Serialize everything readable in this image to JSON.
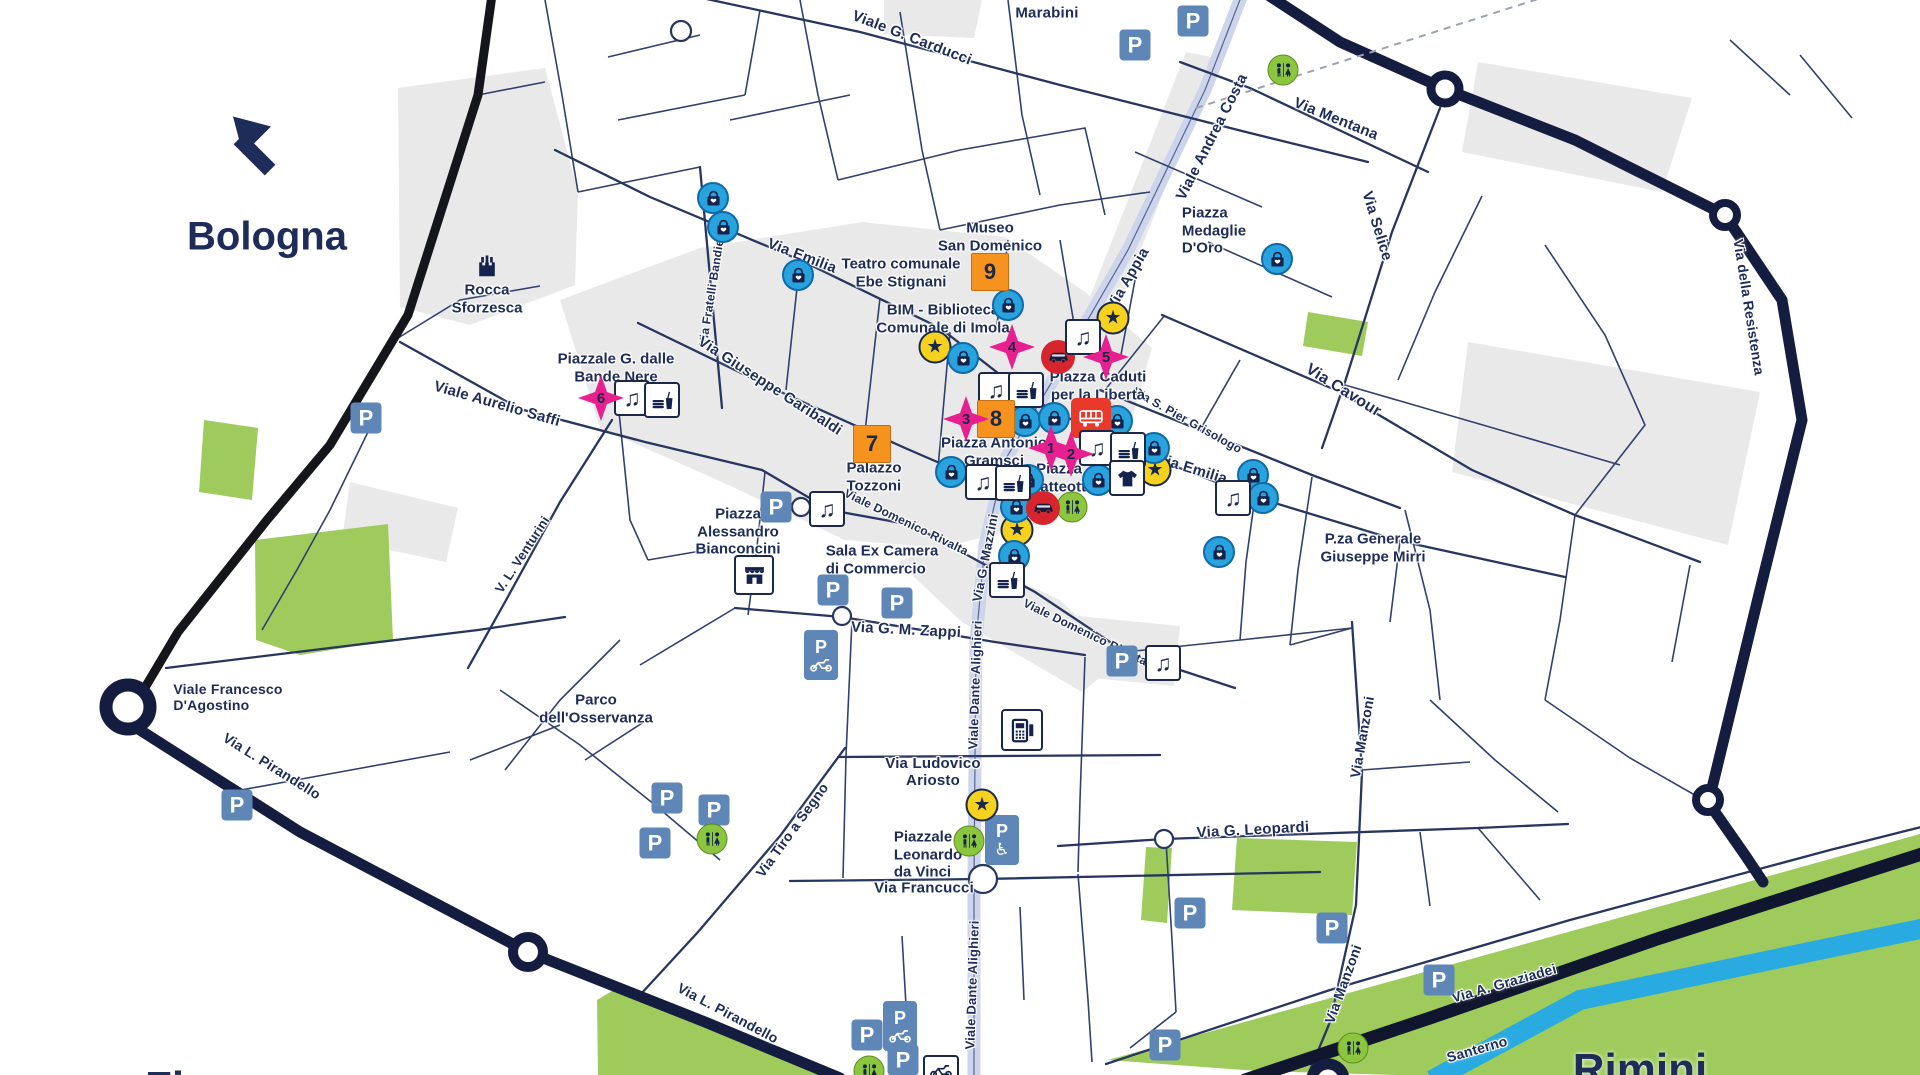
{
  "map": {
    "direction_labels": {
      "bologna": "Bologna",
      "rimini": "Rimini",
      "firenze": "Firenze"
    },
    "colors": {
      "navy_text": "#1d2c58",
      "thin_street": "#31406c",
      "ring_road": "#141d40",
      "boundary_black": "#15151c",
      "river_blue": "#29abe2",
      "main_axis_band": "#cdd5ec",
      "park_green": "#9ecb5c",
      "building_gray": "#e9e9ea",
      "parking_blue": "#5e86b7",
      "poi_yellow": "#f6d21f",
      "shopping_blue": "#29a3de",
      "restricted_red": "#d6252e",
      "bus_red": "#e8392b",
      "marker_orange": "#f6921e",
      "marker_pink": "#e81f8e",
      "wc_green": "#8cc63e"
    },
    "icon_glyphs": {
      "parking": "P",
      "music": "♫",
      "star": "★",
      "wheelchair": "♿"
    },
    "street_labels": [
      {
        "t": "Marabini",
        "x": 1047,
        "y": 13,
        "r": 0,
        "s": 15
      },
      {
        "t": "Viale G. Carducci",
        "x": 912,
        "y": 38,
        "r": 21,
        "s": 15
      },
      {
        "t": "Via Mentana",
        "x": 1336,
        "y": 119,
        "r": 22,
        "s": 15
      },
      {
        "t": "Via Selice",
        "x": 1377,
        "y": 226,
        "r": 73,
        "s": 15
      },
      {
        "t": "Viale Andrea Costa",
        "x": 1212,
        "y": 137,
        "r": -63,
        "s": 15
      },
      {
        "t": "Via Appia",
        "x": 1128,
        "y": 279,
        "r": -60,
        "s": 15
      },
      {
        "t": "Via Emilia",
        "x": 802,
        "y": 256,
        "r": 21,
        "s": 15
      },
      {
        "t": "Via Emilia",
        "x": 1192,
        "y": 469,
        "r": 17,
        "s": 15
      },
      {
        "t": "Via Fratelli Bandiera",
        "x": 713,
        "y": 287,
        "r": -81,
        "s": 12
      },
      {
        "t": "Via Giuseppe Garibaldi",
        "x": 770,
        "y": 386,
        "r": 33,
        "s": 15
      },
      {
        "t": "Viale Aurelio Saffi",
        "x": 497,
        "y": 404,
        "r": 16,
        "s": 15
      },
      {
        "t": "Via Cavour",
        "x": 1343,
        "y": 391,
        "r": 32,
        "s": 16
      },
      {
        "t": "Via della Resistenza",
        "x": 1749,
        "y": 307,
        "r": 81,
        "s": 14
      },
      {
        "t": "Via S. Pier Grisologo",
        "x": 1187,
        "y": 421,
        "r": 29,
        "s": 12
      },
      {
        "t": "Viale Domenico Rivalta",
        "x": 906,
        "y": 523,
        "r": 26,
        "s": 12
      },
      {
        "t": "Viale Domenico Rivalta",
        "x": 1085,
        "y": 633,
        "r": 26,
        "s": 12
      },
      {
        "t": "Via G. Mazzini",
        "x": 986,
        "y": 558,
        "r": -79,
        "s": 13
      },
      {
        "t": "Viale Dante Alighieri",
        "x": 976,
        "y": 685,
        "r": -88,
        "s": 13
      },
      {
        "t": "Viale Dante Alighieri",
        "x": 973,
        "y": 985,
        "r": -88,
        "s": 13
      },
      {
        "t": "Via G. M. Zappi",
        "x": 906,
        "y": 630,
        "r": 3,
        "s": 15
      },
      {
        "t": "Via Ludovico\nAriosto",
        "x": 933,
        "y": 772,
        "r": 0,
        "s": 15
      },
      {
        "t": "Via Francucci",
        "x": 924,
        "y": 888,
        "r": 0,
        "s": 15
      },
      {
        "t": "Via G. Leopardi",
        "x": 1253,
        "y": 830,
        "r": -3,
        "s": 15
      },
      {
        "t": "Via Manzoni",
        "x": 1362,
        "y": 737,
        "r": -80,
        "s": 14
      },
      {
        "t": "Via Manzoni",
        "x": 1343,
        "y": 984,
        "r": -70,
        "s": 14
      },
      {
        "t": "Via A. Graziadei",
        "x": 1504,
        "y": 983,
        "r": -16,
        "s": 14
      },
      {
        "t": "Santerno",
        "x": 1477,
        "y": 1049,
        "r": -16,
        "s": 14
      },
      {
        "t": "Via Tiro a Segno",
        "x": 792,
        "y": 830,
        "r": -54,
        "s": 14
      },
      {
        "t": "Via L. Pirandello",
        "x": 272,
        "y": 766,
        "r": 32,
        "s": 14
      },
      {
        "t": "Via L. Pirandello",
        "x": 728,
        "y": 1013,
        "r": 28,
        "s": 14
      },
      {
        "t": "V. L. Venturini",
        "x": 523,
        "y": 555,
        "r": -57,
        "s": 13
      },
      {
        "t": "Viale Francesco\nD'Agostino",
        "x": 228,
        "y": 697,
        "r": 0,
        "s": 14,
        "al": "l"
      }
    ],
    "poi_labels": [
      {
        "t": "Rocca\nSforzesca",
        "x": 487,
        "y": 299
      },
      {
        "t": "Museo\nSan Domenico",
        "x": 990,
        "y": 237
      },
      {
        "t": "Teatro comunale\nEbe Stignani",
        "x": 901,
        "y": 273
      },
      {
        "t": "BIM - Biblioteca\nComunale di Imola",
        "x": 943,
        "y": 319
      },
      {
        "t": "Piazza\nMedaglie\nD'Oro",
        "x": 1214,
        "y": 231,
        "al": "l"
      },
      {
        "t": "Piazza Caduti\nper la Libertà",
        "x": 1098,
        "y": 386
      },
      {
        "t": "Piazza Antonio\nGramsci",
        "x": 994,
        "y": 452
      },
      {
        "t": "Piazza\nMatteotti",
        "x": 1059,
        "y": 478
      },
      {
        "t": "Palazzo\nTozzoni",
        "x": 874,
        "y": 477,
        "al": "l"
      },
      {
        "t": "Piazzale G. dalle\nBande Nere",
        "x": 616,
        "y": 368
      },
      {
        "t": "Piazza\nAlessandro\nBianconcini",
        "x": 738,
        "y": 532
      },
      {
        "t": "Sala Ex Camera\ndi Commercio",
        "x": 882,
        "y": 560,
        "al": "l"
      },
      {
        "t": "Parco\ndell'Osservanza",
        "x": 596,
        "y": 709
      },
      {
        "t": "Piazzale\nLeonardo\nda Vinci",
        "x": 928,
        "y": 855,
        "al": "l"
      },
      {
        "t": "P.za Generale\nGiuseppe Mirri",
        "x": 1373,
        "y": 548
      }
    ],
    "numbered_markers": {
      "orange": [
        {
          "n": "9",
          "x": 990,
          "y": 272
        },
        {
          "n": "8",
          "x": 996,
          "y": 419
        },
        {
          "n": "7",
          "x": 872,
          "y": 444
        }
      ],
      "pink": [
        {
          "n": "6",
          "x": 601,
          "y": 398
        },
        {
          "n": "4",
          "x": 1012,
          "y": 347
        },
        {
          "n": "5",
          "x": 1106,
          "y": 357
        },
        {
          "n": "3",
          "x": 966,
          "y": 419
        },
        {
          "n": "1",
          "x": 1051,
          "y": 448
        },
        {
          "n": "2",
          "x": 1071,
          "y": 454
        }
      ]
    },
    "icons": [
      {
        "type": "parking",
        "x": 1135,
        "y": 45
      },
      {
        "type": "parking",
        "x": 1193,
        "y": 21
      },
      {
        "type": "parking",
        "x": 366,
        "y": 418
      },
      {
        "type": "parking",
        "x": 776,
        "y": 507
      },
      {
        "type": "parking",
        "x": 833,
        "y": 590
      },
      {
        "type": "parking",
        "x": 897,
        "y": 603
      },
      {
        "type": "parking",
        "x": 667,
        "y": 798
      },
      {
        "type": "parking",
        "x": 714,
        "y": 810
      },
      {
        "type": "parking",
        "x": 655,
        "y": 843
      },
      {
        "type": "parking",
        "x": 237,
        "y": 805
      },
      {
        "type": "parking",
        "x": 1122,
        "y": 661
      },
      {
        "type": "parking",
        "x": 1190,
        "y": 913
      },
      {
        "type": "parking",
        "x": 1332,
        "y": 928
      },
      {
        "type": "parking",
        "x": 1439,
        "y": 980
      },
      {
        "type": "parking",
        "x": 1165,
        "y": 1045
      },
      {
        "type": "parking",
        "x": 867,
        "y": 1035
      },
      {
        "type": "parking",
        "x": 903,
        "y": 1060
      },
      {
        "type": "parking-moto",
        "x": 821,
        "y": 655
      },
      {
        "type": "parking-moto",
        "x": 900,
        "y": 1026
      },
      {
        "type": "moto-box",
        "x": 941,
        "y": 1070
      },
      {
        "type": "parking-disabled",
        "x": 1002,
        "y": 840
      },
      {
        "type": "wc",
        "x": 1283,
        "y": 70
      },
      {
        "type": "wc",
        "x": 1072,
        "y": 507
      },
      {
        "type": "wc",
        "x": 712,
        "y": 839
      },
      {
        "type": "wc",
        "x": 969,
        "y": 841
      },
      {
        "type": "wc",
        "x": 1353,
        "y": 1048
      },
      {
        "type": "wc",
        "x": 869,
        "y": 1071
      },
      {
        "type": "star",
        "x": 935,
        "y": 347
      },
      {
        "type": "star",
        "x": 1113,
        "y": 318
      },
      {
        "type": "star",
        "x": 1155,
        "y": 470
      },
      {
        "type": "star",
        "x": 1017,
        "y": 530
      },
      {
        "type": "star",
        "x": 982,
        "y": 805
      },
      {
        "type": "bag",
        "x": 713,
        "y": 198
      },
      {
        "type": "bag",
        "x": 723,
        "y": 227
      },
      {
        "type": "bag",
        "x": 798,
        "y": 275
      },
      {
        "type": "bag",
        "x": 1008,
        "y": 305
      },
      {
        "type": "bag",
        "x": 963,
        "y": 358
      },
      {
        "type": "bag",
        "x": 1025,
        "y": 421
      },
      {
        "type": "bag",
        "x": 1054,
        "y": 418
      },
      {
        "type": "bag",
        "x": 1117,
        "y": 421
      },
      {
        "type": "bag",
        "x": 951,
        "y": 472
      },
      {
        "type": "bag",
        "x": 1028,
        "y": 480
      },
      {
        "type": "bag",
        "x": 1098,
        "y": 480
      },
      {
        "type": "bag",
        "x": 1016,
        "y": 507
      },
      {
        "type": "bag",
        "x": 1154,
        "y": 448
      },
      {
        "type": "bag",
        "x": 1014,
        "y": 556
      },
      {
        "type": "bag",
        "x": 1219,
        "y": 552
      },
      {
        "type": "bag",
        "x": 1253,
        "y": 475
      },
      {
        "type": "bag",
        "x": 1263,
        "y": 498
      },
      {
        "type": "bag",
        "x": 1277,
        "y": 259
      },
      {
        "type": "car",
        "x": 1058,
        "y": 357
      },
      {
        "type": "car",
        "x": 1043,
        "y": 508
      },
      {
        "type": "bus",
        "x": 1091,
        "y": 418
      },
      {
        "type": "music",
        "x": 632,
        "y": 398
      },
      {
        "type": "music",
        "x": 996,
        "y": 390
      },
      {
        "type": "music",
        "x": 1083,
        "y": 337
      },
      {
        "type": "music",
        "x": 1097,
        "y": 448
      },
      {
        "type": "music",
        "x": 983,
        "y": 482
      },
      {
        "type": "music",
        "x": 827,
        "y": 509
      },
      {
        "type": "music",
        "x": 1163,
        "y": 663
      },
      {
        "type": "music",
        "x": 1233,
        "y": 498
      },
      {
        "type": "food",
        "x": 662,
        "y": 400
      },
      {
        "type": "food",
        "x": 1026,
        "y": 390
      },
      {
        "type": "food",
        "x": 1128,
        "y": 450
      },
      {
        "type": "food",
        "x": 1013,
        "y": 483
      },
      {
        "type": "food",
        "x": 1007,
        "y": 580
      },
      {
        "type": "tshirt",
        "x": 1127,
        "y": 478
      },
      {
        "type": "store",
        "x": 754,
        "y": 575
      },
      {
        "type": "phone",
        "x": 1022,
        "y": 730
      },
      {
        "type": "castle",
        "x": 487,
        "y": 266
      }
    ]
  }
}
